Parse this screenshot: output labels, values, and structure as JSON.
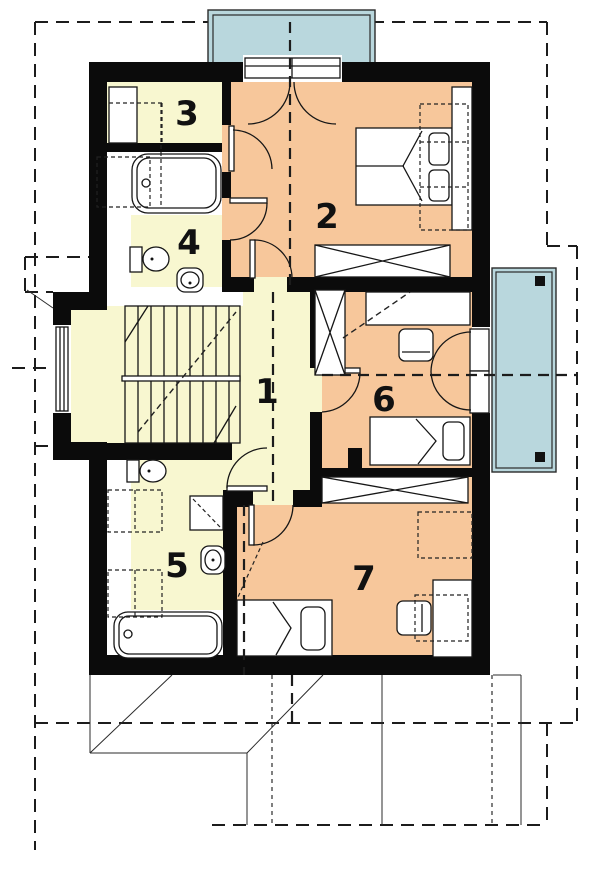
{
  "title": "Upper floor plan",
  "colors": {
    "wall": "#0b0b0b",
    "room_warm": "#f7c79b",
    "room_light": "#f8f7d0",
    "balcony": "#b9d7dd",
    "paper": "#ffffff"
  },
  "rooms": [
    {
      "number": "1",
      "name": "hall-staircase",
      "x": 267,
      "y": 390
    },
    {
      "number": "2",
      "name": "bedroom-master",
      "x": 327,
      "y": 215
    },
    {
      "number": "3",
      "name": "wardrobe-room",
      "x": 187,
      "y": 112
    },
    {
      "number": "4",
      "name": "bathroom-upper",
      "x": 189,
      "y": 241
    },
    {
      "number": "5",
      "name": "bathroom-lower",
      "x": 177,
      "y": 564
    },
    {
      "number": "6",
      "name": "bedroom-middle",
      "x": 384,
      "y": 398
    },
    {
      "number": "7",
      "name": "bedroom-bottom",
      "x": 364,
      "y": 577
    }
  ],
  "features": {
    "balconies": [
      "balcony-top",
      "balcony-right"
    ],
    "fixtures": [
      "bathtub",
      "toilet",
      "washbasin",
      "shower"
    ],
    "furniture": [
      "double-bed",
      "single-bed",
      "wardrobe",
      "desk",
      "chair"
    ],
    "stairs": "u-shaped-staircase"
  }
}
